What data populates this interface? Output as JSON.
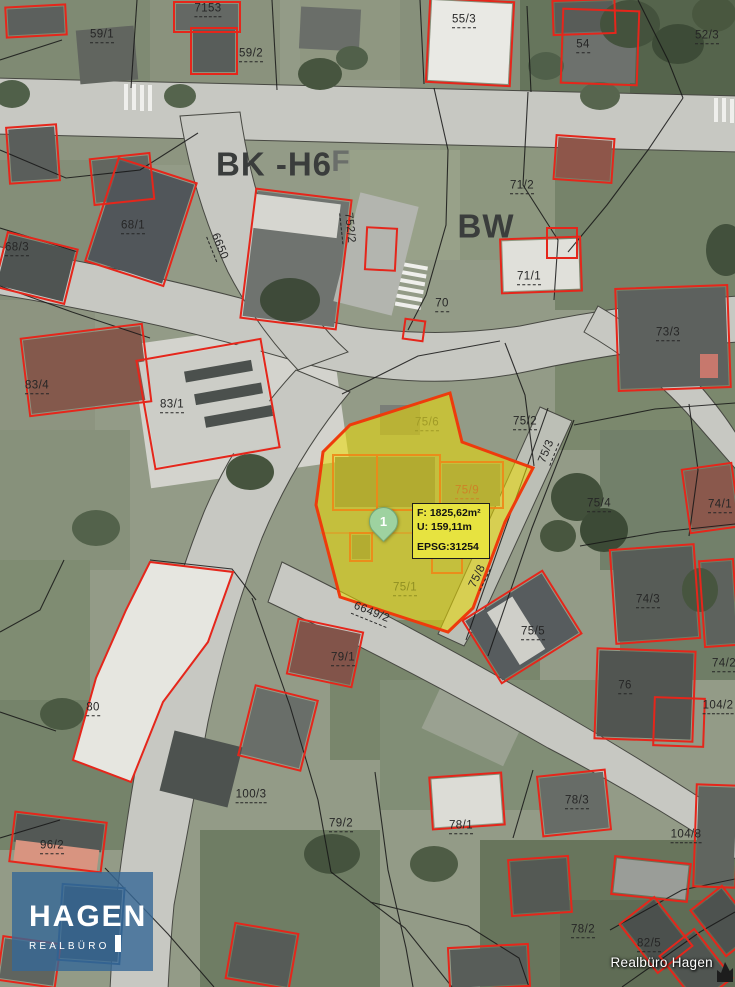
{
  "map": {
    "zone_labels": [
      {
        "t": "BK -H6",
        "x": 274,
        "y": 164,
        "s": 33,
        "c": "#3a3d3c"
      },
      {
        "t": "F",
        "x": 341,
        "y": 162,
        "s": 30,
        "c": "#6a6e6a"
      },
      {
        "t": "BW",
        "x": 486,
        "y": 226,
        "s": 33,
        "c": "#3a3d3c"
      }
    ],
    "parcel_labels": [
      {
        "t": "7153",
        "x": 208,
        "y": 10
      },
      {
        "t": "59/1",
        "x": 102,
        "y": 36
      },
      {
        "t": "59/2",
        "x": 251,
        "y": 55
      },
      {
        "t": "55/3",
        "x": 464,
        "y": 21
      },
      {
        "t": "54",
        "x": 583,
        "y": 46
      },
      {
        "t": "52/3",
        "x": 707,
        "y": 37
      },
      {
        "t": "71/2",
        "x": 522,
        "y": 187
      },
      {
        "t": "68/1",
        "x": 133,
        "y": 227
      },
      {
        "t": "68/3",
        "x": 17,
        "y": 249
      },
      {
        "t": "6650",
        "x": 218,
        "y": 247,
        "r": 68
      },
      {
        "t": "752/2",
        "x": 348,
        "y": 228,
        "r": 84
      },
      {
        "t": "71/1",
        "x": 529,
        "y": 278
      },
      {
        "t": "70",
        "x": 442,
        "y": 305
      },
      {
        "t": "73/3",
        "x": 668,
        "y": 334
      },
      {
        "t": "83/4",
        "x": 37,
        "y": 387
      },
      {
        "t": "83/1",
        "x": 172,
        "y": 406
      },
      {
        "t": "75/2",
        "x": 525,
        "y": 423
      },
      {
        "t": "75/6",
        "x": 427,
        "y": 424,
        "c": "#a09a26"
      },
      {
        "t": "75/3",
        "x": 548,
        "y": 452,
        "r": -68
      },
      {
        "t": "75/9",
        "x": 467,
        "y": 492,
        "c": "#cd8326"
      },
      {
        "t": "75/4",
        "x": 599,
        "y": 505
      },
      {
        "t": "74/1",
        "x": 720,
        "y": 506
      },
      {
        "t": "75/8",
        "x": 479,
        "y": 577,
        "r": -64
      },
      {
        "t": "75/1",
        "x": 405,
        "y": 589,
        "c": "#8f8f22"
      },
      {
        "t": "6649/2",
        "x": 371,
        "y": 614,
        "r": 22
      },
      {
        "t": "74/3",
        "x": 648,
        "y": 601
      },
      {
        "t": "75/5",
        "x": 533,
        "y": 633
      },
      {
        "t": "79/1",
        "x": 343,
        "y": 659
      },
      {
        "t": "76",
        "x": 625,
        "y": 687
      },
      {
        "t": "74/2",
        "x": 724,
        "y": 665
      },
      {
        "t": "104/2",
        "x": 718,
        "y": 707
      },
      {
        "t": "80",
        "x": 93,
        "y": 709
      },
      {
        "t": "100/3",
        "x": 251,
        "y": 796
      },
      {
        "t": "78/3",
        "x": 577,
        "y": 802
      },
      {
        "t": "79/2",
        "x": 341,
        "y": 825
      },
      {
        "t": "78/1",
        "x": 461,
        "y": 827
      },
      {
        "t": "104/8",
        "x": 686,
        "y": 836
      },
      {
        "t": "96/2",
        "x": 52,
        "y": 847
      },
      {
        "t": "78/2",
        "x": 583,
        "y": 931
      },
      {
        "t": "82/5",
        "x": 649,
        "y": 945
      }
    ]
  },
  "highlight": {
    "marker_label": "1",
    "info_box": {
      "area": "F: 1825,62m²",
      "perimeter": "U: 159,11m",
      "epsg": "EPSG:31254"
    }
  },
  "watermark": {
    "name": "HAGEN",
    "subtitle": "REALBÜRO"
  },
  "attribution": "Realbüro Hagen",
  "colors": {
    "parcel-outline": "#e5261b",
    "highlight-fill": "#ecdc00",
    "highlight-border": "#ee3b0c",
    "subparcel-line": "#ef8818",
    "info-box-bg": "#e7e340",
    "marker-fill": "#9ed2a0",
    "watermark-bg": "rgba(54,104,150,0.8)"
  }
}
